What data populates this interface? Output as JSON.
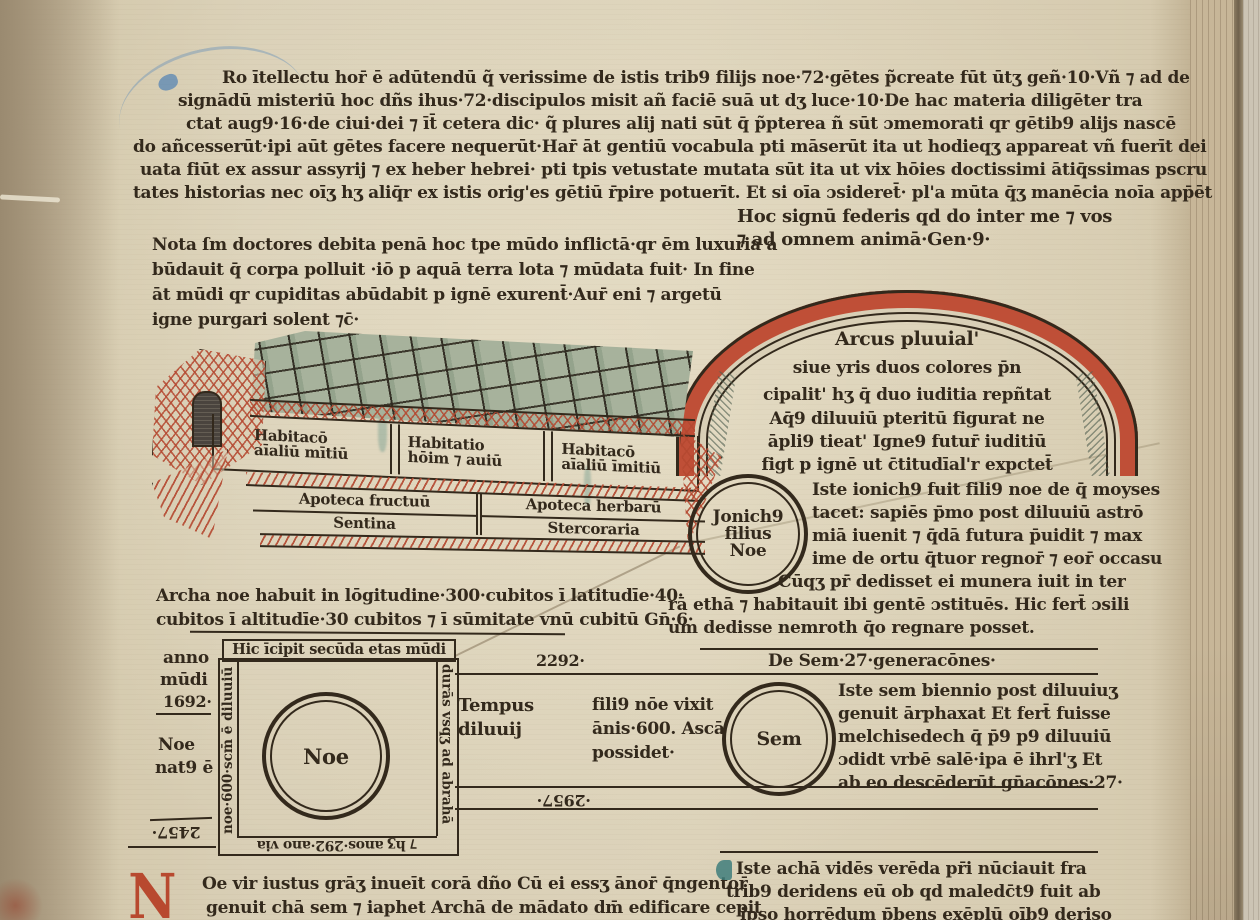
{
  "colors": {
    "ink": "#33291c",
    "rubric_red": "#b8492f",
    "teal": "#3f7e7b",
    "parchment": "#d9cfb6",
    "rainbow_red": "#bf4f37",
    "roof_green": "#a7b29c"
  },
  "top_block": {
    "lines": [
      "Ro ītellectu hor̄ ē adūtendū q̃ verissime de istis trib9 filijs noe·72·gētes p̃create fūt ūtʒ geñ·10·Vñ ⁊ ad de",
      "signādū misteriū hoc dñs ihus·72·discipulos misit añ faciē suā ut dʒ luce·10·De hac materia diligēter tra",
      "ctat aug9·16·de ciui·dei ⁊ īt̄ cetera dic· q̃ plures alij nati sūt q̄ p̃pterea ñ sūt ɔmemorati qr gētib9 alijs nascē",
      "do añcesserūt·ipi aūt gētes facere nequerūt·Har̄ āt gentiū vocabula pti māserūt ita ut hodieqʒ appareat vñ fuerīt dei",
      "uata fiūt ex assur assyrij ⁊ ex heber hebrei· pti tpis vetustate mutata sūt ita ut vix hōies doctissimi ātiq̄ssimas pscru",
      "tates historias nec oīʒ hʒ aliq̄r ex istis orig'es gētiū r̄pire potuerīt. Et si oīa ɔsideret̄· pl'a mūta q̄ʒ manēcia noīa app̄ēt"
    ]
  },
  "gen9_note": {
    "lines": [
      "Hoc signū federis qd do inter me ⁊ vos",
      "⁊ ad omnem animā·Gen·9·"
    ]
  },
  "nota_block": {
    "lines": [
      "Nota ſm doctores debita penā hoc tpe mūdo inflictā·qr ēm luxuria a",
      "būdauit q̄ corpa polluit ·iō p aquā terra lota ⁊ mūdata fuit· In fine",
      "āt mūdi qr cupiditas abūdabit p ignē exurent̄·Aur̄ eni ⁊ argetū",
      "igne purgari solent ⁊c̄·"
    ]
  },
  "rainbow": {
    "lines": [
      "Arcus pluuial'",
      "siue yris duos colores p̄n",
      "cipalit' hʒ q̄ duo iuditia repñtat",
      "Aq̄9 diluuiū pteritū figurat ne",
      "āpli9 tieat' Igne9 futur̄ iuditiū",
      "figt p ignē ut c̄titudīal'r expctet̄"
    ]
  },
  "ark": {
    "compartments": [
      {
        "l1": "Habitacō",
        "l2": "aīaliū mītiū"
      },
      {
        "l1": "Habitatio",
        "l2": "hōim ⁊ auiū"
      },
      {
        "l1": "Habitacō",
        "l2": "aīaliū īmitiū"
      }
    ],
    "row2": [
      "Apoteca fructuū",
      "Apoteca herbarū"
    ],
    "row3": [
      "Sentina",
      "Stercoraria"
    ]
  },
  "jonichus": {
    "circle": [
      "Jonich9",
      "filius",
      "Noe"
    ],
    "lines": [
      "Iste ionich9 fuit fili9 noe de q̄ moyses",
      "tacet: sapiēs p̄mo post diluuiū astrō",
      "miā iuenit ⁊ q̄dā futura p̄uidit ⁊ max",
      "ime de ortu q̄tuor regnor̄ ⁊ eor̄ occasu",
      "Cūqʒ pr̄ dedisset ei munera iuit in ter"
    ],
    "wide_lines": [
      "rā ethā ⁊ habitauit ibi gentē ɔstituēs. Hic fert̄ ɔsili",
      "um dedisse nemroth q̄o regnare posset."
    ]
  },
  "archa_note": {
    "lines": [
      "Archa noe habuit in lōgitudine·300·cubitos ī latitudīe·40·",
      "cubitos ī altitudīe·30 cubitos ⁊ ī sūmitate vnū cubitū Gn̄·6·"
    ]
  },
  "genealogy": {
    "heading": "Hic īcipit secūda etas mūdi",
    "margin": {
      "l1": "anno",
      "l2": "mūdi",
      "l3": "1692·",
      "l4": "Noe",
      "l5": "nat9 ē",
      "num_rot": "2457·"
    },
    "noe": "Noe",
    "rot_left": "noe·600·scm̄ ē diluuiū",
    "rot_right": "durās vsqʒ ad abrahā",
    "rot_bottom": "⁊ hʒ anos·292·ano via",
    "num_top": "2292·",
    "num_bottom": "·2957·",
    "de_sem": "De Sem·27·generacōnes·",
    "tempus": {
      "l1": "Tempus",
      "l2": "diluuij"
    },
    "filius": {
      "l1": "fili9 nōe vixit",
      "l2": "ānis·600. Ascā",
      "l3": "possidet·"
    },
    "sem": "Sem",
    "sem_lines": [
      "Iste sem biennio post diluuiuʒ",
      "genuit ārphaxat Et fert̄ fuisse",
      "melchisedech q̄ p̄9 p9 diluuiū",
      "ɔdidt vrbē salē·ipa ē ihrl'ʒ Et",
      "ab eo descēderūt gn̄acōnes·27·"
    ]
  },
  "bottom_left": {
    "initial": "N",
    "lines": [
      "Oe vir iustus grāʒ inueīt corā dño Cū ei essʒ ānor̄ q̄ngentor̄",
      "genuit chā sem ⁊ iaphet Archā de mādato dm̄ edificare cepit"
    ]
  },
  "bottom_right": {
    "lines": [
      "Iste achā vidēs verēda pr̄i nūciauit fra",
      "trib9 deridens eū ob qd maledc̄t9 fuit ab",
      "ipso horrēdum p̄bens exēplū oīb9 deriso"
    ]
  }
}
